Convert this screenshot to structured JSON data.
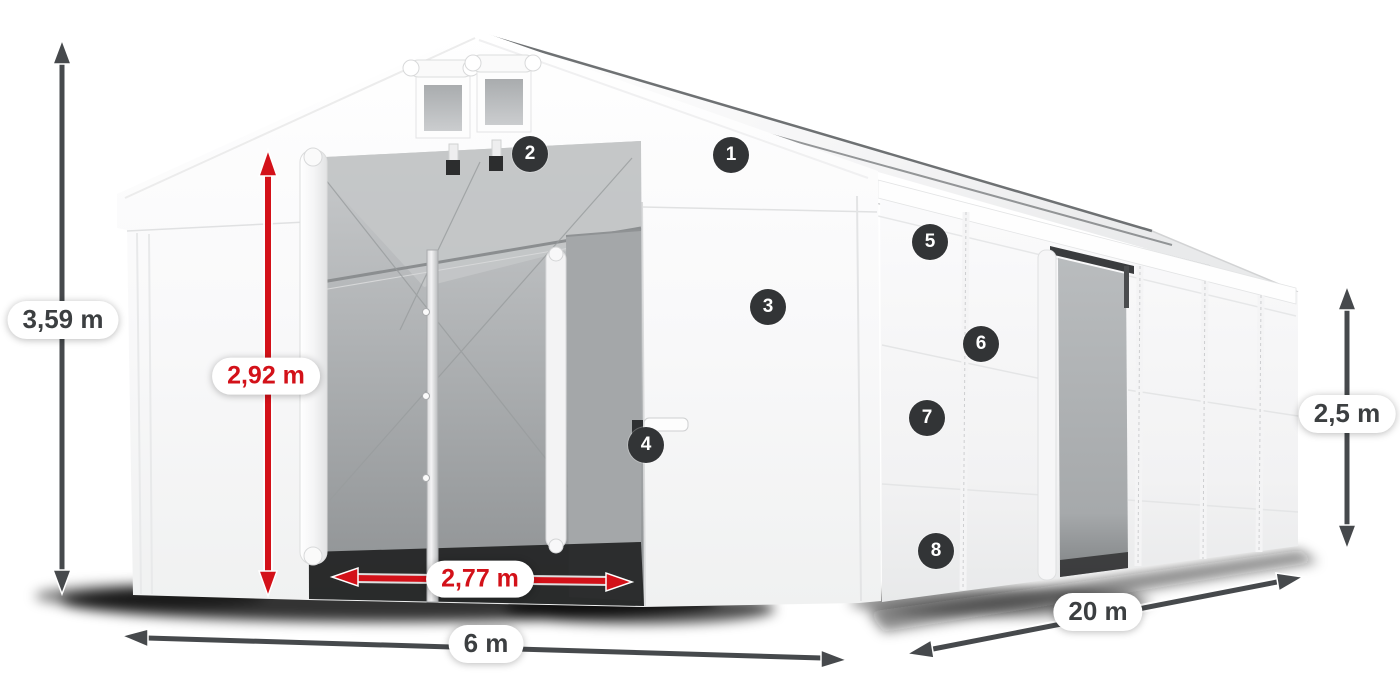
{
  "callouts": {
    "items": [
      {
        "id": "1"
      },
      {
        "id": "2"
      },
      {
        "id": "3"
      },
      {
        "id": "4"
      },
      {
        "id": "5"
      },
      {
        "id": "6"
      },
      {
        "id": "7"
      },
      {
        "id": "8"
      }
    ]
  },
  "dimensions": {
    "total_height": {
      "label": "3,59 m",
      "style": "dark",
      "orientation": "vertical-left"
    },
    "door_height": {
      "label": "2,92 m",
      "style": "red",
      "orientation": "vertical-front"
    },
    "door_width": {
      "label": "2,77 m",
      "style": "red",
      "orientation": "horizontal-front"
    },
    "width": {
      "label": "6 m",
      "style": "dark",
      "orientation": "horizontal-bottom"
    },
    "length": {
      "label": "20 m",
      "style": "dark",
      "orientation": "diagonal-right"
    },
    "side_height": {
      "label": "2,5 m",
      "style": "dark",
      "orientation": "vertical-right"
    }
  },
  "colors": {
    "accent_red": "#d31119",
    "arrow_dark": "#46494c",
    "badge_background": "#323436",
    "badge_text": "#ffffff",
    "pill_background": "#ffffff",
    "pill_text": "#3c3f41",
    "tent_white": "#fafafa",
    "interior_gray": "#a4a7a9"
  }
}
